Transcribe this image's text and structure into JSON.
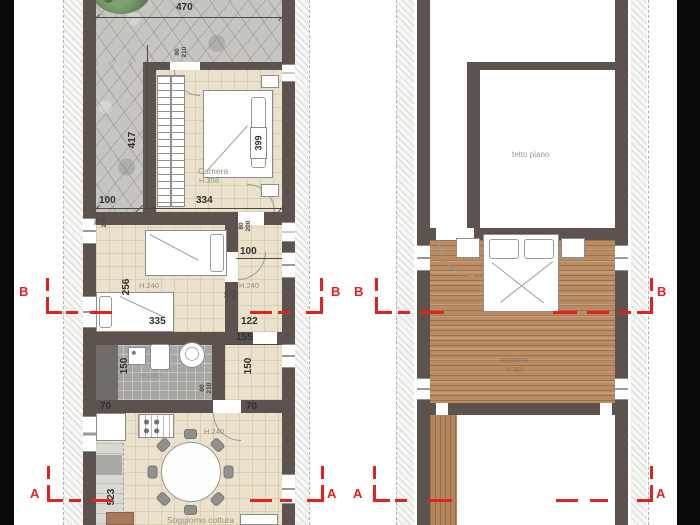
{
  "sections": {
    "a": "A",
    "b": "B"
  },
  "left_plan": {
    "garden": {
      "width": "470",
      "height": "417"
    },
    "camera": {
      "name": "Camera",
      "ceiling": "H.358",
      "bed_width": "399",
      "width": "334",
      "side_strip": "100",
      "door_w": "90",
      "door_h": "210"
    },
    "openings": {
      "win_w": "76",
      "win_h": "228",
      "door1_w": "80",
      "door1_h": "200",
      "door2_w": "80",
      "door2_h": "210",
      "door3_w": "80",
      "door3_h": "210"
    },
    "bedroom2": {
      "ceiling": "H.240",
      "depth": "256",
      "bed_width": "335"
    },
    "hall": {
      "ceiling": "H.240",
      "width": "100",
      "width2": "122"
    },
    "bath": {
      "ceiling": "H.240",
      "depth": "150",
      "width": "155",
      "depth2": "150"
    },
    "living": {
      "ceiling": "H.240",
      "name": "Soggiorno cottura",
      "pillar_left": "70",
      "pillar_right": "70",
      "depth": "523"
    }
  },
  "right_plan": {
    "roof_label": "tetto piano",
    "loft_label": "soppalco",
    "loft_ceiling": "H.305"
  }
}
